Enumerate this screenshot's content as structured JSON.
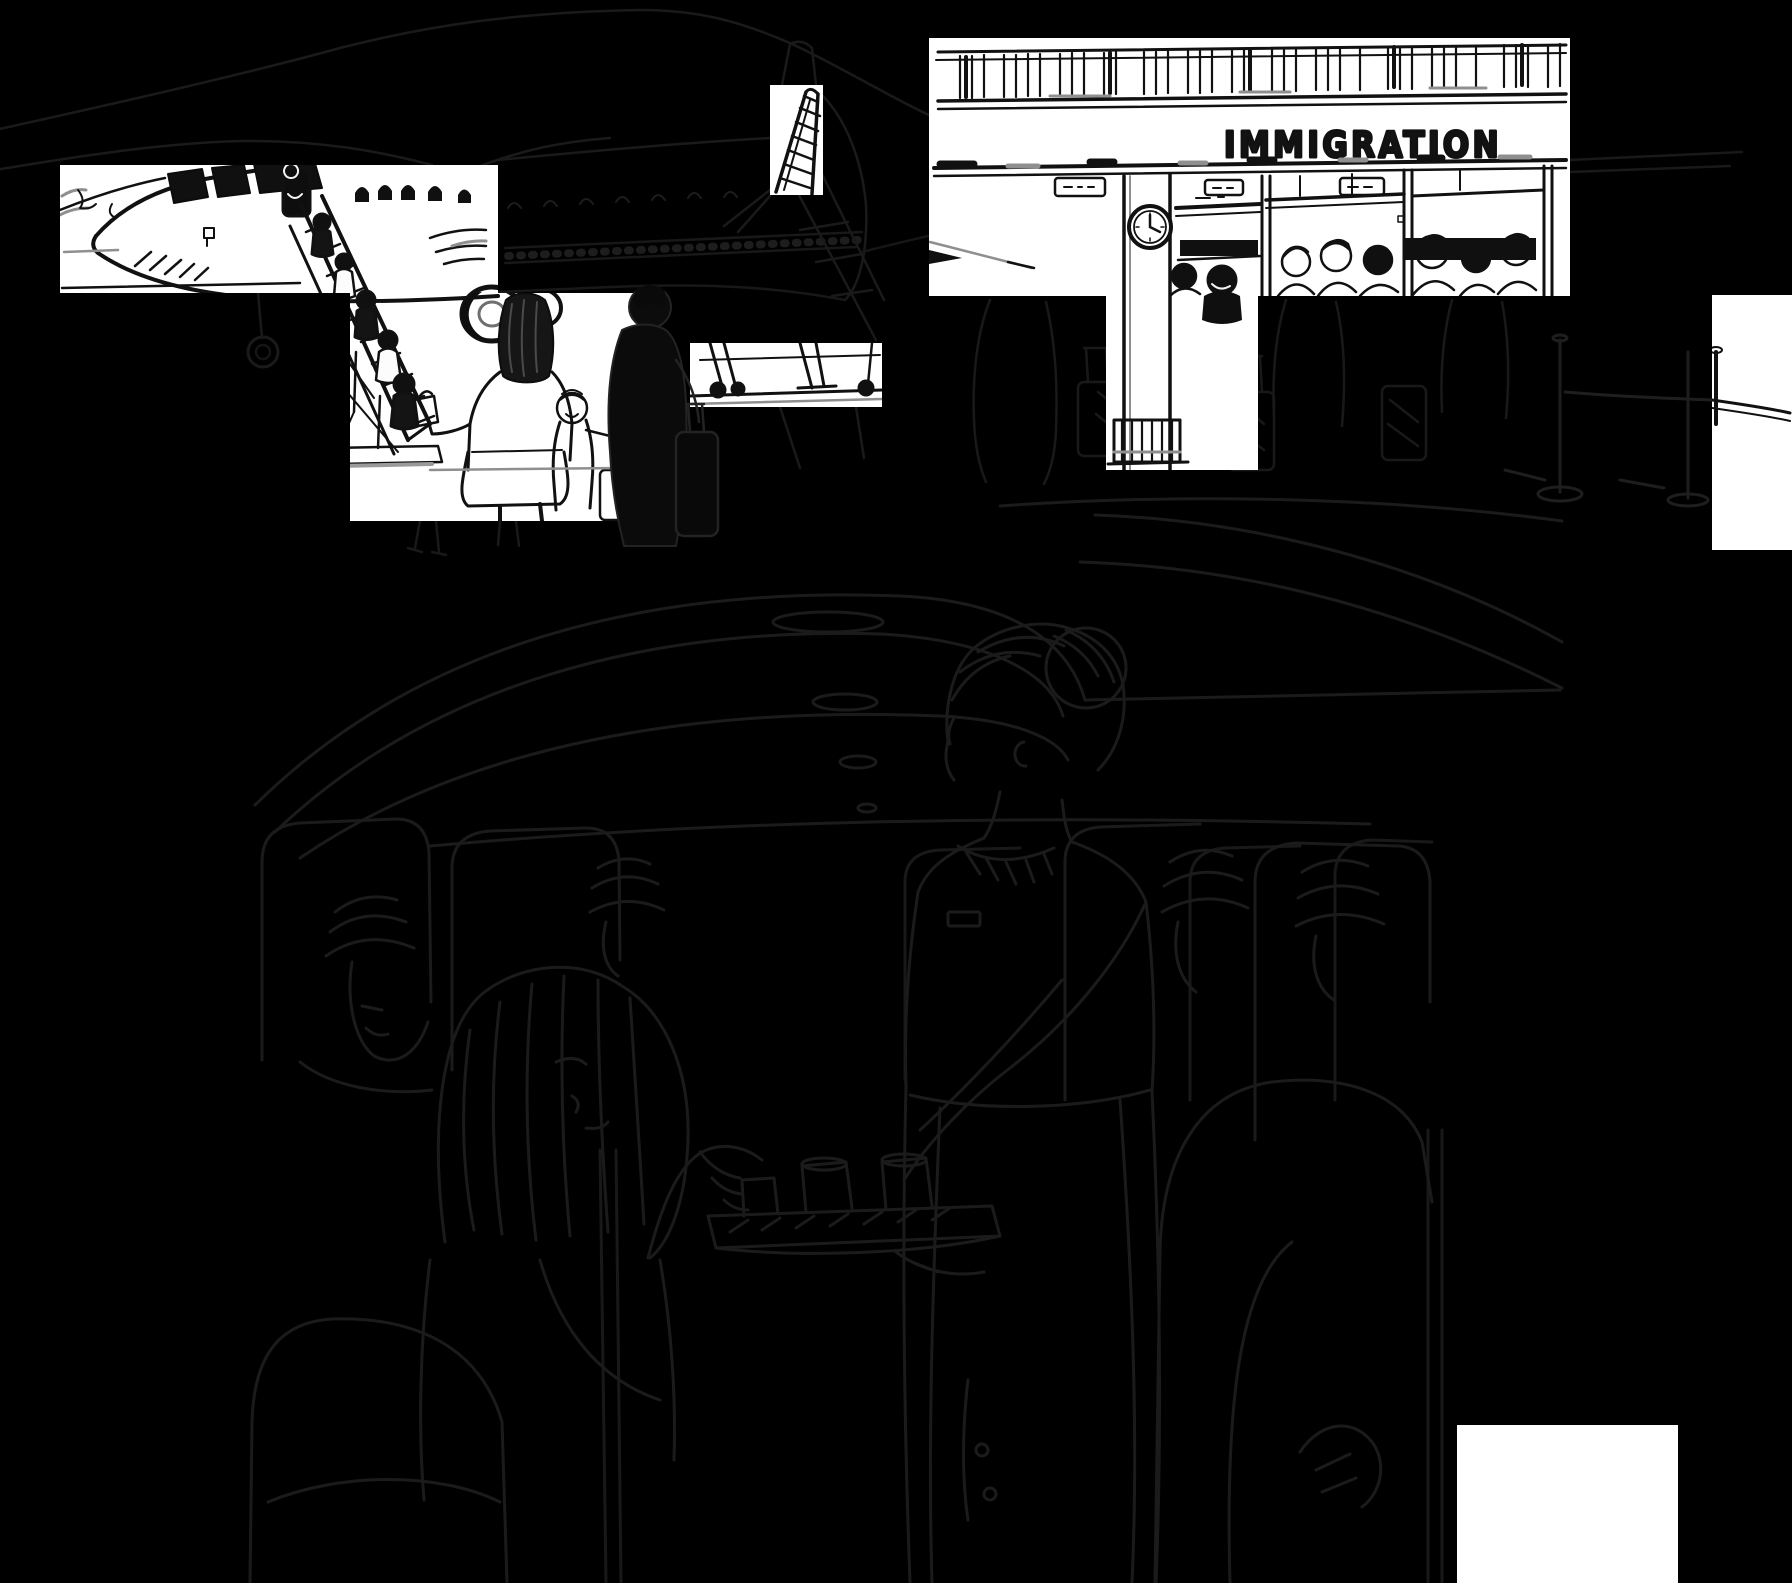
{
  "artwork": {
    "kind": "pen-and-ink travel illustration, partially masked by black",
    "immigration": {
      "sign_text": "IMMIGRATION"
    },
    "panels": [
      {
        "id": "boarding",
        "label": "passengers climbing airstairs to airplane, mountains behind"
      },
      {
        "id": "immigration",
        "label": "immigration hall with clock pillar, booths and queue with luggage"
      },
      {
        "id": "cabin",
        "label": "flight attendant serving drinks from tray to seated passengers"
      }
    ],
    "palette": {
      "background": "#000000",
      "paper": "#ffffff",
      "ink": "#111111",
      "ghost_line": "#1a1a1a",
      "pencil_gray": "#909090"
    }
  }
}
